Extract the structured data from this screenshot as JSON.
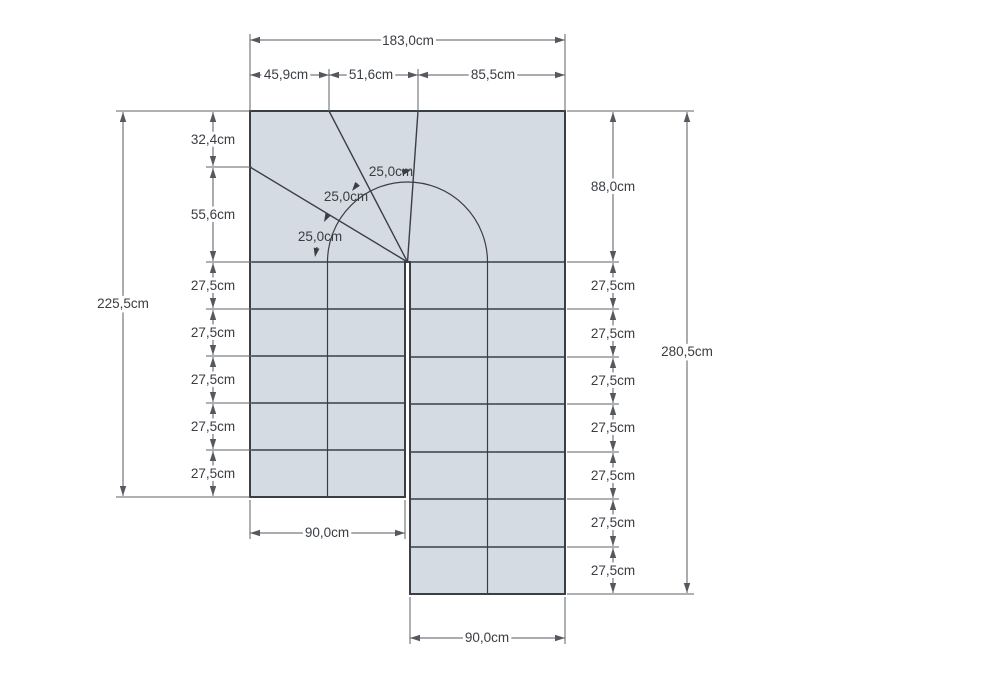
{
  "drawing": {
    "kind": "staircase-floor-plan",
    "unit": "cm",
    "colors": {
      "background": "#ffffff",
      "stair_fill": "#d5dbe3",
      "stair_line": "#3a3f46",
      "dimension_line": "#55595f",
      "text": "#3a3d42"
    },
    "structure": {
      "left_flight_steps": 5,
      "right_flight_steps": 7,
      "winder_treads": 4
    }
  },
  "dimensions": {
    "top": {
      "total": "183,0cm",
      "segments": [
        "45,9cm",
        "51,6cm",
        "85,5cm"
      ]
    },
    "left": {
      "total": "225,5cm",
      "segments": [
        "32,4cm",
        "55,6cm",
        "27,5cm",
        "27,5cm",
        "27,5cm",
        "27,5cm",
        "27,5cm"
      ]
    },
    "right": {
      "total": "280,5cm",
      "segments": [
        "88,0cm",
        "27,5cm",
        "27,5cm",
        "27,5cm",
        "27,5cm",
        "27,5cm",
        "27,5cm",
        "27,5cm"
      ]
    },
    "bottom_left": {
      "width": "90,0cm"
    },
    "bottom_right": {
      "width": "90,0cm"
    },
    "walkline": {
      "tread_depths": [
        "25,0cm",
        "25,0cm",
        "25,0cm"
      ]
    }
  }
}
